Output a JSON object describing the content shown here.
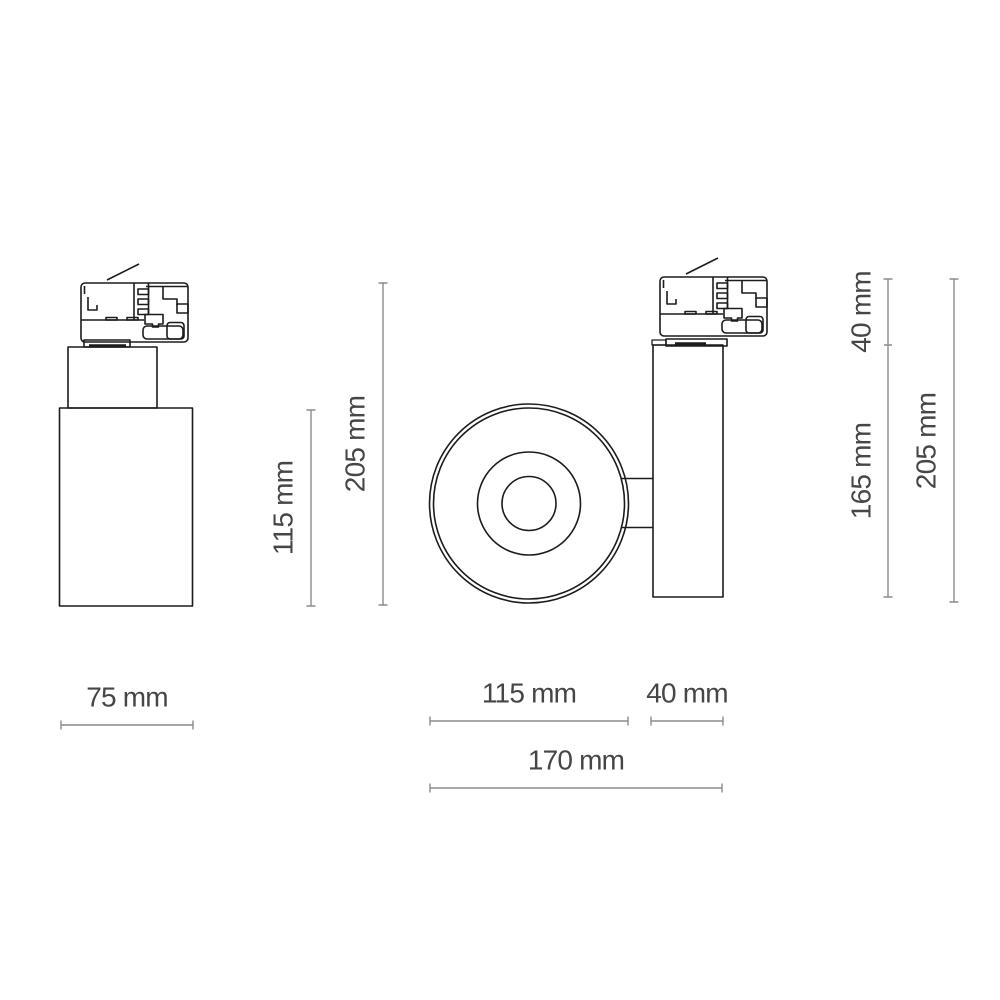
{
  "page": {
    "background": "#ffffff",
    "subject": "Technical dimension drawing of an LED track-light spotlight (three orthographic views: side view, front lens view, profile view with 3-phase track adapter)"
  },
  "views": {
    "side": "side view of cylindrical spotlight with track adapter",
    "front": "front view of round lens head with mounting arm",
    "profile": "profile view of housing with track adapter"
  },
  "dimensions": {
    "side": {
      "body_height": "115 mm",
      "overall_height": "205 mm",
      "body_width": "75 mm"
    },
    "front": {
      "head_diameter": "115 mm",
      "arm_depth": "40 mm",
      "overall_width": "170 mm"
    },
    "profile": {
      "adapter_height": "40 mm",
      "housing_height": "165 mm",
      "overall_height": "205 mm"
    }
  },
  "colors": {
    "background": "#ffffff",
    "outline": "#1c1c1c",
    "dimension_line": "#8c8c8c",
    "label_text": "#464646"
  }
}
